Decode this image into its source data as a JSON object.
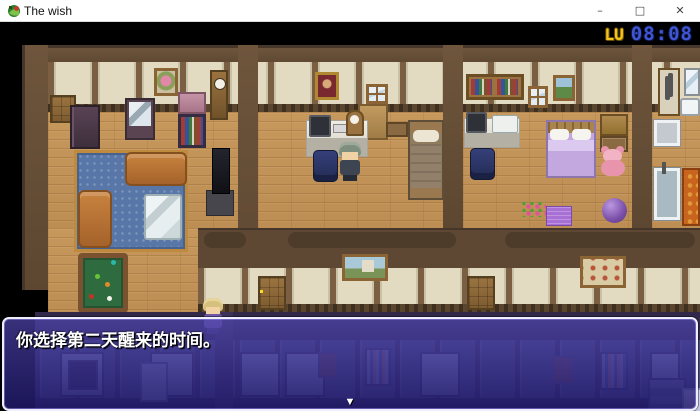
{
  "window": {
    "title": "The wish",
    "controls": [
      {
        "id": "minimize",
        "glyph": "–"
      },
      {
        "id": "maximize",
        "glyph": "□"
      },
      {
        "id": "close",
        "glyph": "✕"
      }
    ]
  },
  "hud": {
    "clock_label": "LU",
    "clock_time": "08:08",
    "clock_label_color": "#f2c41d",
    "clock_time_color": "#3f55d2"
  },
  "dialogue": {
    "text": "你选择第二天醒来的时间。",
    "continue_glyph": "▼"
  },
  "colors": {
    "dialog_border": "#eeeeff",
    "dialog_bg_top": "rgba(80,70,175,0.70)",
    "dialog_bg_bottom": "rgba(32,25,105,0.84)",
    "wood_floor": "#c6985c",
    "wall_cream": "#e2dbc1",
    "wall_brown": "#6e553c",
    "carpet_blue": "#5877a8",
    "titlebar_bg": "#ffffff"
  }
}
